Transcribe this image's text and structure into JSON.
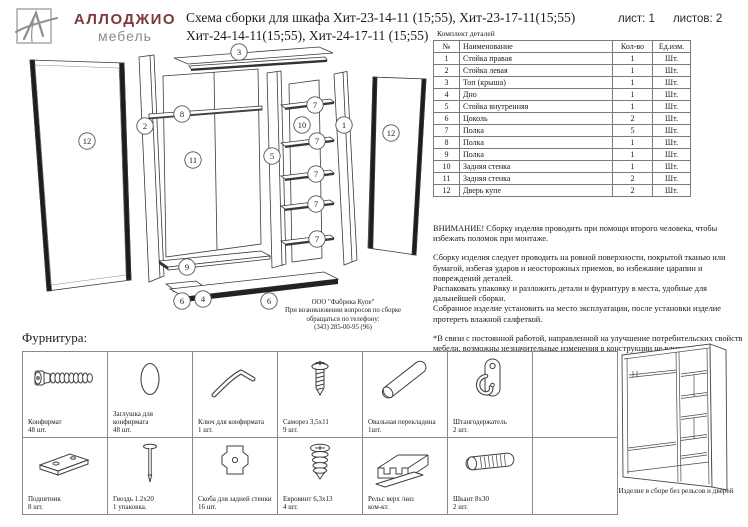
{
  "logo": {
    "brand": "АЛЛОДЖИО",
    "sub": "мебель",
    "brand_color": "#7b383e"
  },
  "header": {
    "title_line1": "Схема сборки для шкафа Хит-23-14-11 (15;55), Хит-23-17-11(15;55)",
    "title_line2": "Хит-24-14-11(15;55), Хит-24-17-11 (15;55)",
    "sheet": "лист: 1",
    "sheets": "листов: 2"
  },
  "parts_table": {
    "caption": "Комплект деталей",
    "columns": [
      "№",
      "Наименование",
      "Кол-во",
      "Ед.изм."
    ],
    "rows": [
      [
        "1",
        "Стойка правая",
        "1",
        "Шт."
      ],
      [
        "2",
        "Стойка левая",
        "1",
        "Шт."
      ],
      [
        "3",
        "Топ (крыша)",
        "1",
        "Шт."
      ],
      [
        "4",
        "Дно",
        "1",
        "Шт."
      ],
      [
        "5",
        "Стойка внутренняя",
        "1",
        "Шт."
      ],
      [
        "6",
        "Цоколь",
        "2",
        "Шт."
      ],
      [
        "7",
        "Полка",
        "5",
        "Шт."
      ],
      [
        "8",
        "Полка",
        "1",
        "Шт."
      ],
      [
        "9",
        "Полка",
        "1",
        "Шт."
      ],
      [
        "10",
        "Задняя стенка",
        "1",
        "Шт."
      ],
      [
        "11",
        "Задняя стенка",
        "2",
        "Шт."
      ],
      [
        "12",
        "Дверь купе",
        "2",
        "Шт."
      ]
    ]
  },
  "notices": {
    "warning": "ВНИМАНИЕ! Сборку изделия проводить при помощи второго человека, чтобы избежать поломок при монтаже.",
    "instructions": "Сборку изделия следует проводить на ровной поверхности, покрытой тканью или бумагой, избегая ударов и неосторожных приемов, во избежание царапин и повреждений деталей.\nРаспаковать упаковку и разложить детали и фурнитуру в места, удобные для дальнейшей сборки.\nСобранное изделие установить на место эксплуатации, после установки изделие протереть влажной салфеткой.",
    "disclaimer": "*В связи с постоянной работой, направленной на улучшение потребительских свойств мебели, возможны незначительные изменения в конструкции не влияющие на функциональные качества изделий."
  },
  "manufacturer": {
    "name": "ООО \"Фабрика Купе\"",
    "line2": "При возникновении вопросов по сборке",
    "line3": "обращаться по телефону:",
    "phone": "(343) 285-00-95 (96)"
  },
  "diagram": {
    "callouts": [
      {
        "label": "3",
        "x": 221,
        "y": 12
      },
      {
        "label": "12",
        "x": 69,
        "y": 101
      },
      {
        "label": "2",
        "x": 127,
        "y": 86
      },
      {
        "label": "8",
        "x": 164,
        "y": 74
      },
      {
        "label": "11",
        "x": 175,
        "y": 120
      },
      {
        "label": "5",
        "x": 254,
        "y": 116
      },
      {
        "label": "10",
        "x": 284,
        "y": 85
      },
      {
        "label": "7",
        "x": 297,
        "y": 65
      },
      {
        "label": "7",
        "x": 299,
        "y": 101
      },
      {
        "label": "7",
        "x": 298,
        "y": 134
      },
      {
        "label": "7",
        "x": 298,
        "y": 164
      },
      {
        "label": "7",
        "x": 299,
        "y": 199
      },
      {
        "label": "1",
        "x": 326,
        "y": 85
      },
      {
        "label": "12",
        "x": 373,
        "y": 93
      },
      {
        "label": "9",
        "x": 169,
        "y": 227
      },
      {
        "label": "6",
        "x": 164,
        "y": 261
      },
      {
        "label": "4",
        "x": 185,
        "y": 259
      },
      {
        "label": "6",
        "x": 251,
        "y": 261
      }
    ]
  },
  "hardware": {
    "caption": "Фурнитура:",
    "items": [
      {
        "name": "Конфирмат",
        "qty": "48 шт.",
        "icon": "confirmat-screw-icon"
      },
      {
        "name": "Заглушка для конфирмата",
        "qty": "48 шт.",
        "icon": "cap-plug-icon"
      },
      {
        "name": "Ключ для конфирмата",
        "qty": "1 шт.",
        "icon": "hex-key-icon"
      },
      {
        "name": "Саморез 3,5х11",
        "qty": "9 шт.",
        "icon": "self-tapping-screw-icon"
      },
      {
        "name": "Овальная перекладина",
        "qty": "1шт.",
        "icon": "oval-rod-icon"
      },
      {
        "name": "Штангодержатель",
        "qty": "2 шт.",
        "icon": "rod-holder-icon"
      },
      {
        "name": "Подпятник",
        "qty": "8 шт.",
        "icon": "foot-plate-icon"
      },
      {
        "name": "Гвоздь 1.2х20",
        "qty": "1 упаковка.",
        "icon": "nail-icon"
      },
      {
        "name": "Скоба для задней стенки",
        "qty": "16 шт.",
        "icon": "back-panel-clip-icon"
      },
      {
        "name": "Евровинт 6,3х13",
        "qty": "4 шт.",
        "icon": "euro-screw-icon"
      },
      {
        "name": "Рельс верх /низ",
        "qty": "ком-кт.",
        "icon": "rail-icon"
      },
      {
        "name": "Шкант 8х30",
        "qty": "2 шт.",
        "icon": "dowel-icon"
      }
    ]
  },
  "assembled": {
    "caption": "Изделие в сборе без рельсов и дверей"
  }
}
